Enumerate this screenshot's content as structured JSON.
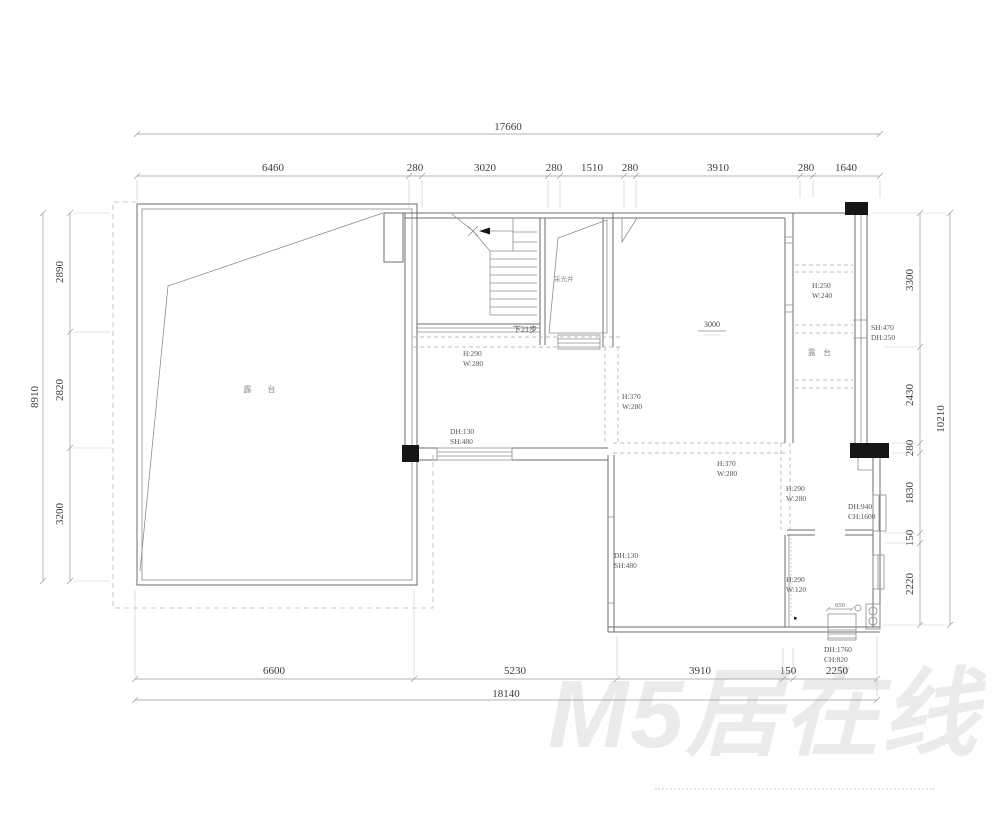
{
  "dimensions": {
    "top": {
      "total": "17660",
      "segments": [
        "6460",
        "280",
        "3020",
        "280",
        "1510",
        "280",
        "3910",
        "280",
        "1640"
      ]
    },
    "bottom": {
      "total": "18140",
      "segments": [
        "6600",
        "5230",
        "3910",
        "150",
        "2250"
      ]
    },
    "left": {
      "total": "8910",
      "segments": [
        "2890",
        "2820",
        "3200"
      ]
    },
    "right": {
      "total": "10210",
      "segments": [
        "3300",
        "2430",
        "280",
        "1830",
        "150",
        "2220"
      ]
    }
  },
  "rooms": {
    "terrace_label": "露 台",
    "light_well_label": "采光井",
    "right_terrace_label": "露 台",
    "stairs_note": "下21步",
    "elevation_mark": "3000"
  },
  "openings": {
    "o1": {
      "l1": "H:290",
      "l2": "W:280"
    },
    "o2": {
      "l1": "H:370",
      "l2": "W:280"
    },
    "o3": {
      "l1": "H:370",
      "l2": "W:280"
    },
    "o4": {
      "l1": "H:290",
      "l2": "W:280"
    },
    "o5": {
      "l1": "DH:130",
      "l2": "SH:480"
    },
    "o6": {
      "l1": "DH:130",
      "l2": "SH:480"
    },
    "o7": {
      "l1": "DH:940",
      "l2": "CH:1600"
    },
    "o8": {
      "l1": "H:290",
      "l2": "W:120"
    },
    "o9": {
      "l1": "DH:1760",
      "l2": "CH:820"
    },
    "o10": {
      "l1": "H:250",
      "l2": "W:240"
    },
    "o11": {
      "l1": "SH:470",
      "l2": "DH:250"
    },
    "o12": {
      "l1": "650"
    }
  },
  "watermark": {
    "text": "M5居在线"
  },
  "colors": {
    "wall": "#6e6e6e",
    "dimension": "#9a9a9a",
    "column": "#161616",
    "watermark": "#ebebeb"
  }
}
